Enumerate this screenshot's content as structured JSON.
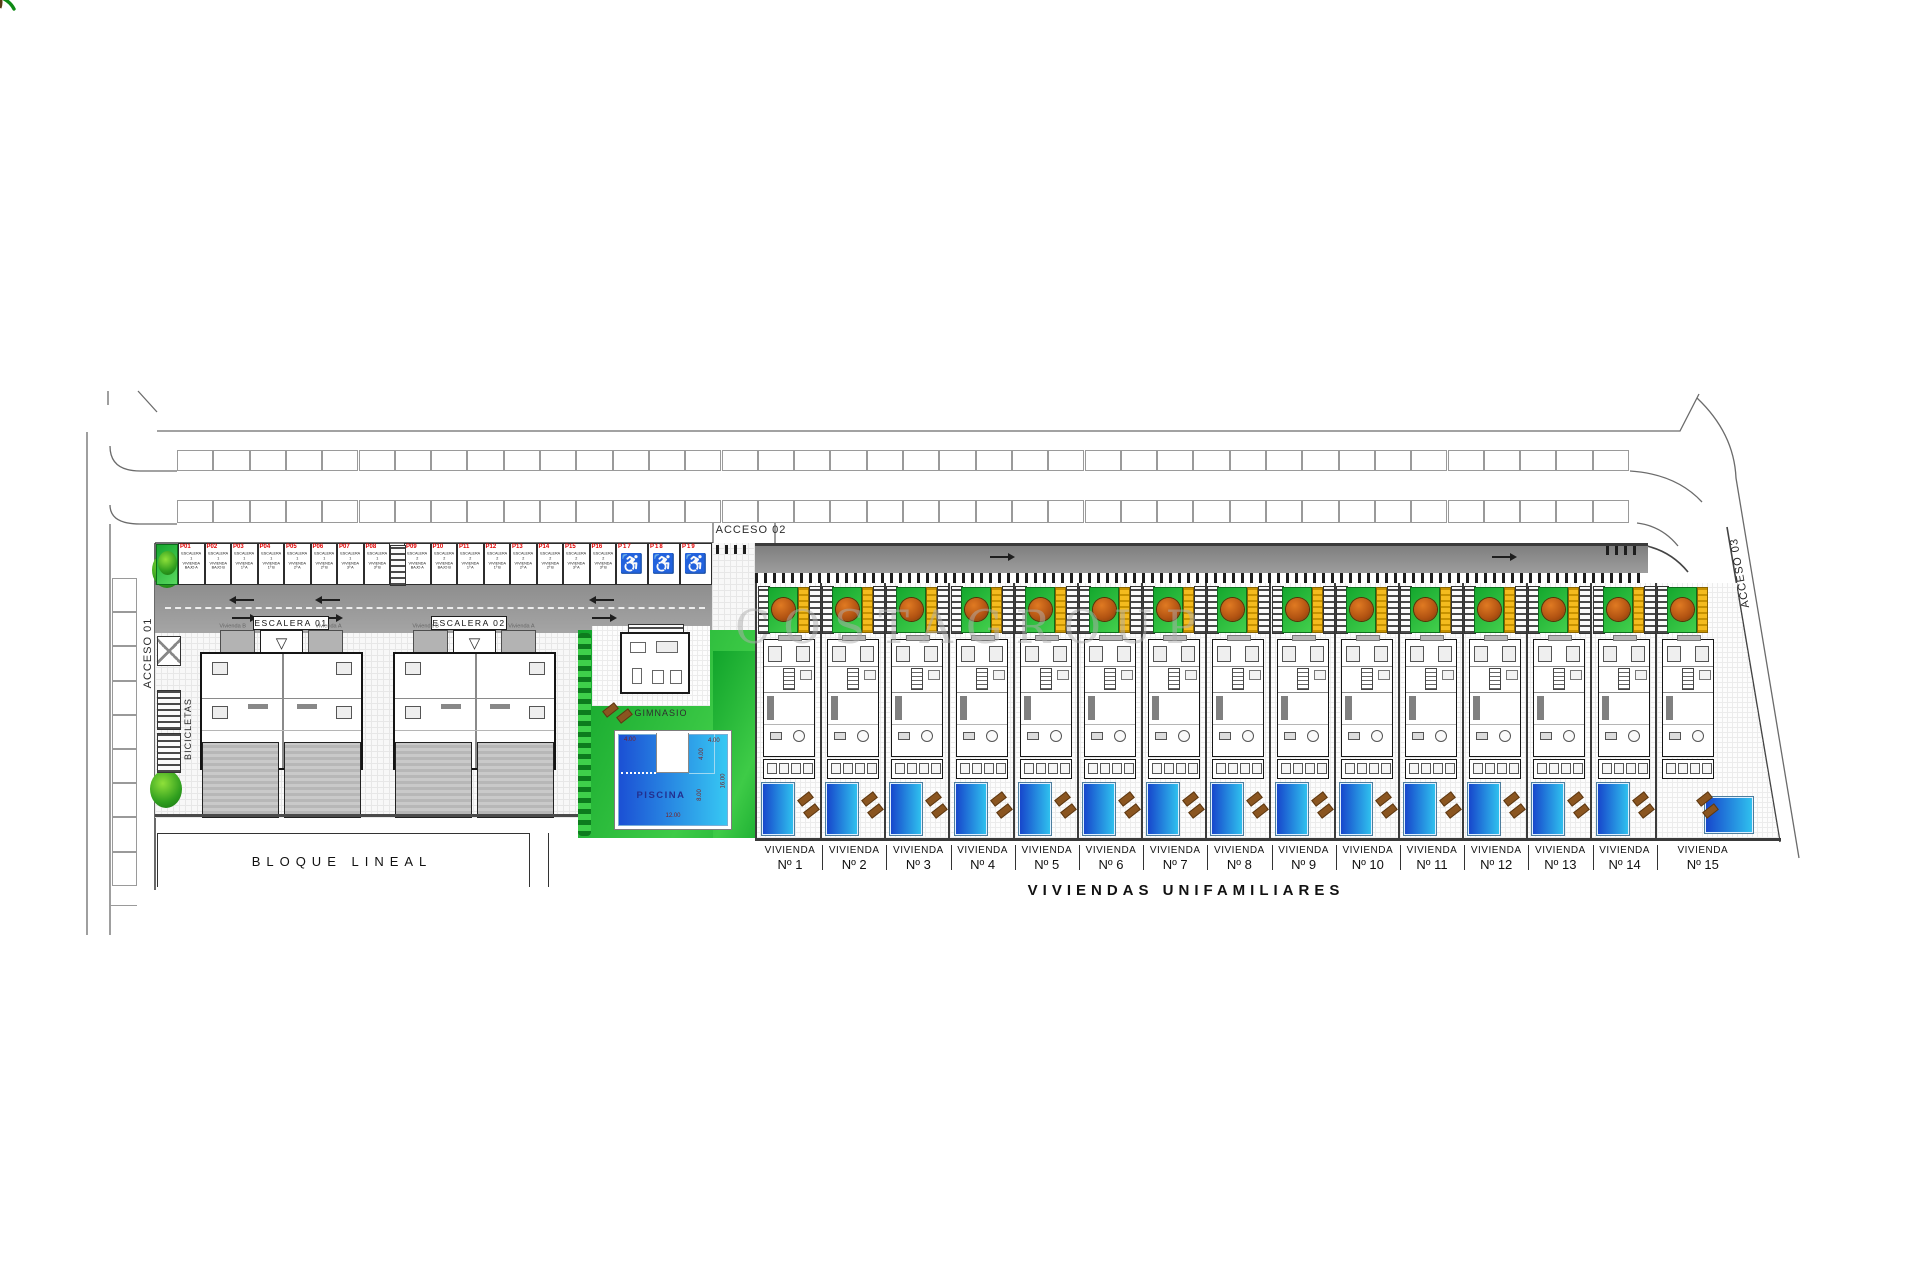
{
  "watermark": "COSTAGROUP",
  "accesses": {
    "a1": "ACCESO 01",
    "a2": "ACCESO 02",
    "a3": "ACCESO 03"
  },
  "bicycle_label": "BICICLETAS",
  "block_label": "BLOQUE LINEAL",
  "gym_label": "GIMNASIO",
  "escalera_road_labels": [
    "ESCALERA 01",
    "ESCALERA 02"
  ],
  "apartments": {
    "unit_b": "Vivienda B",
    "unit_a": "Vivienda A"
  },
  "pool": {
    "label": "PISCINA",
    "dims": {
      "top_left": "4.00",
      "top_right": "4.00",
      "right_upper": "4.00",
      "right_side": "16.00",
      "mid": "8.00",
      "bottom": "12.00"
    }
  },
  "parking": {
    "spaces": [
      {
        "id": "P01",
        "lines": [
          "ESCALERA 1",
          "VIVIENDA",
          "BAJO A"
        ],
        "accessible": false
      },
      {
        "id": "P02",
        "lines": [
          "ESCALERA 1",
          "VIVIENDA",
          "BAJO B"
        ],
        "accessible": false
      },
      {
        "id": "P03",
        "lines": [
          "ESCALERA 1",
          "VIVIENDA",
          "1º A"
        ],
        "accessible": false
      },
      {
        "id": "P04",
        "lines": [
          "ESCALERA 1",
          "VIVIENDA",
          "1º B"
        ],
        "accessible": false
      },
      {
        "id": "P05",
        "lines": [
          "ESCALERA 1",
          "VIVIENDA",
          "2º A"
        ],
        "accessible": false
      },
      {
        "id": "P06",
        "lines": [
          "ESCALERA 1",
          "VIVIENDA",
          "2º B"
        ],
        "accessible": false
      },
      {
        "id": "P07",
        "lines": [
          "ESCALERA 1",
          "VIVIENDA",
          "3º A"
        ],
        "accessible": false
      },
      {
        "id": "P08",
        "lines": [
          "ESCALERA 1",
          "VIVIENDA",
          "3º B"
        ],
        "accessible": false
      },
      {
        "id": "P09",
        "lines": [
          "ESCALERA 2",
          "VIVIENDA",
          "BAJO A"
        ],
        "accessible": false
      },
      {
        "id": "P10",
        "lines": [
          "ESCALERA 2",
          "VIVIENDA",
          "BAJO B"
        ],
        "accessible": false
      },
      {
        "id": "P11",
        "lines": [
          "ESCALERA 2",
          "VIVIENDA",
          "1º A"
        ],
        "accessible": false
      },
      {
        "id": "P12",
        "lines": [
          "ESCALERA 2",
          "VIVIENDA",
          "1º B"
        ],
        "accessible": false
      },
      {
        "id": "P13",
        "lines": [
          "ESCALERA 2",
          "VIVIENDA",
          "2º A"
        ],
        "accessible": false
      },
      {
        "id": "P14",
        "lines": [
          "ESCALERA 2",
          "VIVIENDA",
          "2º B"
        ],
        "accessible": false
      },
      {
        "id": "P15",
        "lines": [
          "ESCALERA 2",
          "VIVIENDA",
          "3º A"
        ],
        "accessible": false
      },
      {
        "id": "P16",
        "lines": [
          "ESCALERA 2",
          "VIVIENDA",
          "3º B"
        ],
        "accessible": false
      },
      {
        "id": "P17",
        "lines": [],
        "accessible": true
      },
      {
        "id": "P18",
        "lines": [],
        "accessible": true
      },
      {
        "id": "P19",
        "lines": [],
        "accessible": true
      }
    ]
  },
  "houses": {
    "unit_label": "VIVIENDA",
    "units": [
      {
        "num": "Nº 1"
      },
      {
        "num": "Nº 2"
      },
      {
        "num": "Nº 3"
      },
      {
        "num": "Nº 4"
      },
      {
        "num": "Nº 5"
      },
      {
        "num": "Nº 6"
      },
      {
        "num": "Nº 7"
      },
      {
        "num": "Nº 8"
      },
      {
        "num": "Nº 9"
      },
      {
        "num": "Nº 10"
      },
      {
        "num": "Nº 11"
      },
      {
        "num": "Nº 12"
      },
      {
        "num": "Nº 13"
      },
      {
        "num": "Nº 14"
      },
      {
        "num": "Nº 15"
      }
    ],
    "section_title": "VIVIENDAS UNIFAMILIARES"
  }
}
